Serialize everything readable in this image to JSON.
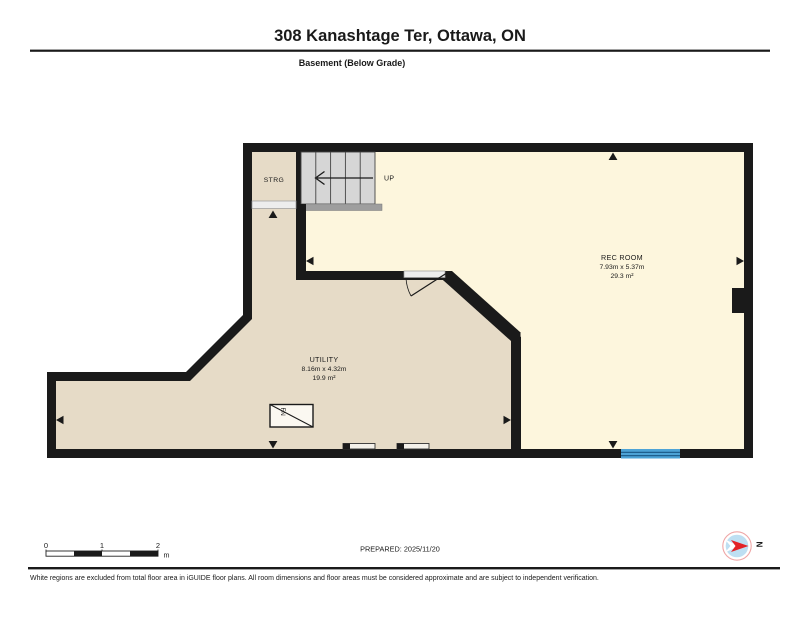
{
  "header": {
    "title": "308 Kanashtage Ter, Ottawa, ON",
    "floor_label": "Basement (Below Grade)"
  },
  "floor_plan": {
    "rooms": [
      {
        "name": "REC ROOM",
        "dimensions": "7.93m x 5.37m",
        "area": "29.3 m²"
      },
      {
        "name": "UTILITY",
        "dimensions": "8.16m x 4.32m",
        "area": "19.9 m²"
      },
      {
        "name": "STRG"
      }
    ],
    "stairs_label": "UP",
    "furnace_label": "FN",
    "colors": {
      "walls": "#1a1a1a",
      "rec_room_floor": "#fdf6dd",
      "utility_floor": "#e6dbc7",
      "stairs": "#d6d6d6",
      "stairs_landing": "#9e9e9e",
      "door_sill": "#ededed",
      "window": "#4da3d6"
    }
  },
  "scale_bar": {
    "ticks": [
      "0",
      "1",
      "2"
    ],
    "unit": "m"
  },
  "prepared": {
    "label": "PREPARED: 2025/11/20"
  },
  "compass": {
    "north_label": "N"
  },
  "footer": {
    "disclaimer": "White regions are excluded from total floor area in iGUIDE floor plans. All room dimensions and floor areas must be considered approximate and are subject to independent verification."
  }
}
